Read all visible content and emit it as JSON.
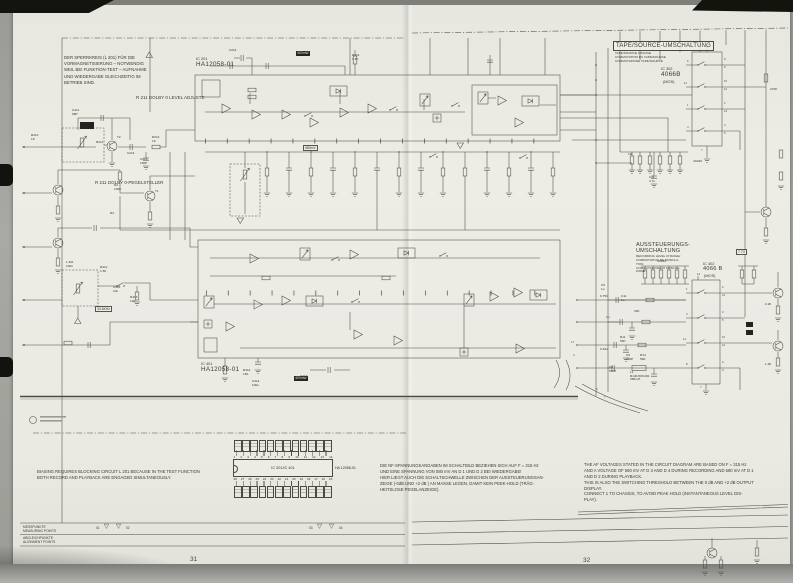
{
  "pages": {
    "left_number": "31",
    "right_number": "32"
  },
  "notes": {
    "blocking_de": "DER SPERRKREIS (L 201) FÜR DIE\nVORMAGNETISIERUNG – NOTWENDIG\nWEIL BEI FUNKTION-TEST – AUFNAHME\nUND WIEDERGABE GLEICHZEITIG IM\nBETRIEB SIND.",
    "adjust_en": "R 211 DOLBY 0 LEVEL ADJUSTE",
    "adjust_de": "R 211 DOLBY 0-PEGELSTELLER",
    "biasing_en": "BIASING REQUIRES BLOCKING CIRCUIT L 201 BECAUSE IN THE TEST FUNCTION\nBOTH RECORD AND PLAYBACK ARE ENGAGED SIMULTANEOUSLY.",
    "nf_de": "DIE NF-SPANNUNGSANGABEN IM SCHALTBILD BEZIEHEN SICH AUF F = 315 Hz\nUND EINE SPANNUNG VON 580 mV AN  D 1  UND  D 2  BEI WIEDERGABE!\nHIER LIEGT AUCH DIE SCHALTSCHWELLE ZWISCHEN DER AUSSTEUERUNGSAN-\nZEIGE (-0dB UND +2 dB )  AN MASSE LEGEN, DAMIT KEIN PEEK-HOLD (TRÄG-\nHEITSLOSE PEGELANZEIGE).",
    "af_en": "THE AF VOLTAGES STATED IN THE CIRCUIT DIAGRAM ARE BASED ON F = 315 Hz\nAND A VOLTAGE OF 580 mV AT D 3 AND D 4 DURING RECORDING AND 580 mV AT D 1\nAND D 2 DURING PLAYBACK.\nTHIS IS ALSO THE SWITCHING THRESHOLD BETWEEN THE 0 dB AND +2 dB OUTPUT\nDISPLAY.\nCONNECT 1 TO CHASSIS, TO AVOID PEAK HOLD (INSTANTANEOUS LEVEL DIS-\nPLAY)."
  },
  "ics": {
    "ic201": {
      "ref": "IC 201",
      "part": "HA12058-01"
    },
    "ic401": {
      "ref": "IC 401",
      "part": "HA12058-01"
    },
    "ic302": {
      "ref": "IC 302",
      "part": "4066B",
      "tech": "(MOS)"
    },
    "ic402": {
      "ref": "IC 402",
      "part": "4066 B",
      "tech": "(MOS)"
    }
  },
  "sections": {
    "tape_source": {
      "title": "TAPE/SOURCE-UMSCHALTUNG",
      "subtitle": "TAPE/SOURCE CHANGE\nCOMMUTATION DU TAPE/SOURCE\nCOMMUTAZIONE TAPE/SOURCE"
    },
    "level_switch": {
      "title": "AUSSTEUERUNGS-\nUMSCHALTUNG",
      "subtitle": "RECORDING LEVEL CHANGE/\nCOMMUTATION DE MODULA-\nTION\nCOMMUTAZIONE DI MODULA-\nZIONE"
    }
  },
  "pinout": {
    "title": "IC 201/IC 401",
    "part": "HA 12058-01",
    "top_pins": [
      "1",
      "2",
      "3",
      "4",
      "5",
      "6",
      "7",
      "8",
      "9",
      "10",
      "11",
      "12",
      "13",
      "14"
    ],
    "bottom_pins": [
      "28",
      "27",
      "26",
      "25",
      "24",
      "23",
      "22",
      "21",
      "20",
      "19",
      "18",
      "17",
      "16",
      "15"
    ],
    "value_box_count": 12
  },
  "legend": {
    "rows": [
      {
        "de": "MESSPUNKTE",
        "en": "MEASURING POINTS"
      },
      {
        "de": "ABGLEICHPUNKTE",
        "en": "ALIGNMENT POINTS"
      }
    ],
    "points": [
      "01",
      "02",
      "03",
      "04"
    ],
    "triangle_glyph": "▽"
  },
  "schematic_labels": [
    {
      "t": "C214",
      "x": 229,
      "y": 49
    },
    {
      "t": "R214\n1.5K",
      "x": 352,
      "y": 54
    },
    {
      "t": "C211\n68P",
      "x": 72,
      "y": 109
    },
    {
      "t": "R213\n1K",
      "x": 31,
      "y": 134
    },
    {
      "t": "R211",
      "x": 96,
      "y": 141
    },
    {
      "t": "T2",
      "x": 117,
      "y": 136
    },
    {
      "t": "C212",
      "x": 127,
      "y": 152
    },
    {
      "t": "R212\n1K",
      "x": 152,
      "y": 136
    },
    {
      "t": "C213\n150P",
      "x": 140,
      "y": 158
    },
    {
      "t": "R2\n100K",
      "x": 114,
      "y": 184
    },
    {
      "t": "T1",
      "x": 155,
      "y": 190
    },
    {
      "t": "R3",
      "x": 110,
      "y": 212
    },
    {
      "t": "L 201\n100u",
      "x": 66,
      "y": 261
    },
    {
      "t": "R412\n1.5K",
      "x": 100,
      "y": 266
    },
    {
      "t": "C412\n10u",
      "x": 113,
      "y": 286
    },
    {
      "t": "R413\n100",
      "x": 130,
      "y": 296
    },
    {
      "t": "33.6KHz",
      "x": 95,
      "y": 306,
      "c": "boxed"
    },
    {
      "t": "580mV",
      "x": 303,
      "y": 145,
      "c": "boxed"
    },
    {
      "t": "600mW",
      "x": 296,
      "y": 51,
      "c": "inv"
    },
    {
      "t": "600mW",
      "x": 294,
      "y": 376,
      "c": "inv"
    },
    {
      "t": "R414\n150",
      "x": 243,
      "y": 369
    },
    {
      "t": "C414\n100u",
      "x": 252,
      "y": 380
    },
    {
      "t": "C413\n10u",
      "x": 300,
      "y": 375
    },
    {
      "t": "7.7V",
      "x": 736,
      "y": 249,
      "c": "boxed"
    },
    {
      "t": "4X22K",
      "x": 693,
      "y": 160
    },
    {
      "t": "4X22K",
      "x": 657,
      "y": 260
    },
    {
      "t": "1M",
      "x": 628,
      "y": 153
    },
    {
      "t": "C11\n4.7u",
      "x": 649,
      "y": 176
    },
    {
      "t": "C5\n1u",
      "x": 601,
      "y": 284
    },
    {
      "t": "6.75V",
      "x": 600,
      "y": 295
    },
    {
      "t": "C11\n1u",
      "x": 621,
      "y": 295
    },
    {
      "t": "33K",
      "x": 634,
      "y": 310
    },
    {
      "t": "1u",
      "x": 606,
      "y": 316
    },
    {
      "t": "0.33u",
      "x": 600,
      "y": 348
    },
    {
      "t": "R11\n56K",
      "x": 620,
      "y": 336
    },
    {
      "t": "C6\n220P",
      "x": 626,
      "y": 354
    },
    {
      "t": "R13\n56K",
      "x": 640,
      "y": 354
    },
    {
      "t": "C8\n560P",
      "x": 609,
      "y": 366
    },
    {
      "t": "L1\nR140-509-001\n380mH",
      "x": 630,
      "y": 371
    },
    {
      "t": "2.2K",
      "x": 765,
      "y": 303
    },
    {
      "t": "1.2K",
      "x": 765,
      "y": 363
    },
    {
      "t": "270K",
      "x": 770,
      "y": 88
    },
    {
      "t": "14",
      "x": 706,
      "y": 46,
      "c": "pn"
    },
    {
      "t": "7",
      "x": 701,
      "y": 149,
      "c": "pn"
    },
    {
      "t": "6",
      "x": 687,
      "y": 60,
      "c": "pn"
    },
    {
      "t": "11",
      "x": 684,
      "y": 82,
      "c": "pn"
    },
    {
      "t": "1",
      "x": 687,
      "y": 104,
      "c": "pn"
    },
    {
      "t": "4",
      "x": 687,
      "y": 126,
      "c": "pn"
    },
    {
      "t": "9",
      "x": 724,
      "y": 58,
      "c": "pn"
    },
    {
      "t": "8",
      "x": 724,
      "y": 66,
      "c": "pn"
    },
    {
      "t": "10",
      "x": 724,
      "y": 80,
      "c": "pn"
    },
    {
      "t": "12",
      "x": 724,
      "y": 88,
      "c": "pn"
    },
    {
      "t": "2",
      "x": 724,
      "y": 102,
      "c": "pn"
    },
    {
      "t": "13",
      "x": 724,
      "y": 110,
      "c": "pn"
    },
    {
      "t": "3",
      "x": 724,
      "y": 124,
      "c": "pn"
    },
    {
      "t": "5",
      "x": 724,
      "y": 132,
      "c": "pn"
    },
    {
      "t": "14",
      "x": 697,
      "y": 273,
      "c": "pn"
    },
    {
      "t": "7",
      "x": 700,
      "y": 386,
      "c": "pn"
    },
    {
      "t": "1",
      "x": 686,
      "y": 288,
      "c": "pn"
    },
    {
      "t": "4",
      "x": 686,
      "y": 313,
      "c": "pn"
    },
    {
      "t": "11",
      "x": 683,
      "y": 338,
      "c": "pn"
    },
    {
      "t": "8",
      "x": 686,
      "y": 363,
      "c": "pn"
    },
    {
      "t": "2",
      "x": 722,
      "y": 286,
      "c": "pn"
    },
    {
      "t": "13",
      "x": 722,
      "y": 294,
      "c": "pn"
    },
    {
      "t": "3",
      "x": 722,
      "y": 311,
      "c": "pn"
    },
    {
      "t": "5",
      "x": 722,
      "y": 319,
      "c": "pn"
    },
    {
      "t": "10",
      "x": 722,
      "y": 336,
      "c": "pn"
    },
    {
      "t": "12",
      "x": 722,
      "y": 344,
      "c": "pn"
    },
    {
      "t": "6",
      "x": 722,
      "y": 361,
      "c": "pn"
    },
    {
      "t": "9",
      "x": 722,
      "y": 369,
      "c": "pn"
    },
    {
      "t": "17",
      "x": 571,
      "y": 341,
      "c": "pn"
    },
    {
      "t": "4",
      "x": 573,
      "y": 354,
      "c": "pn"
    },
    {
      "t": "5",
      "x": 596,
      "y": 388,
      "c": "pn"
    },
    {
      "t": "7",
      "x": 604,
      "y": 396,
      "c": "pn"
    }
  ]
}
